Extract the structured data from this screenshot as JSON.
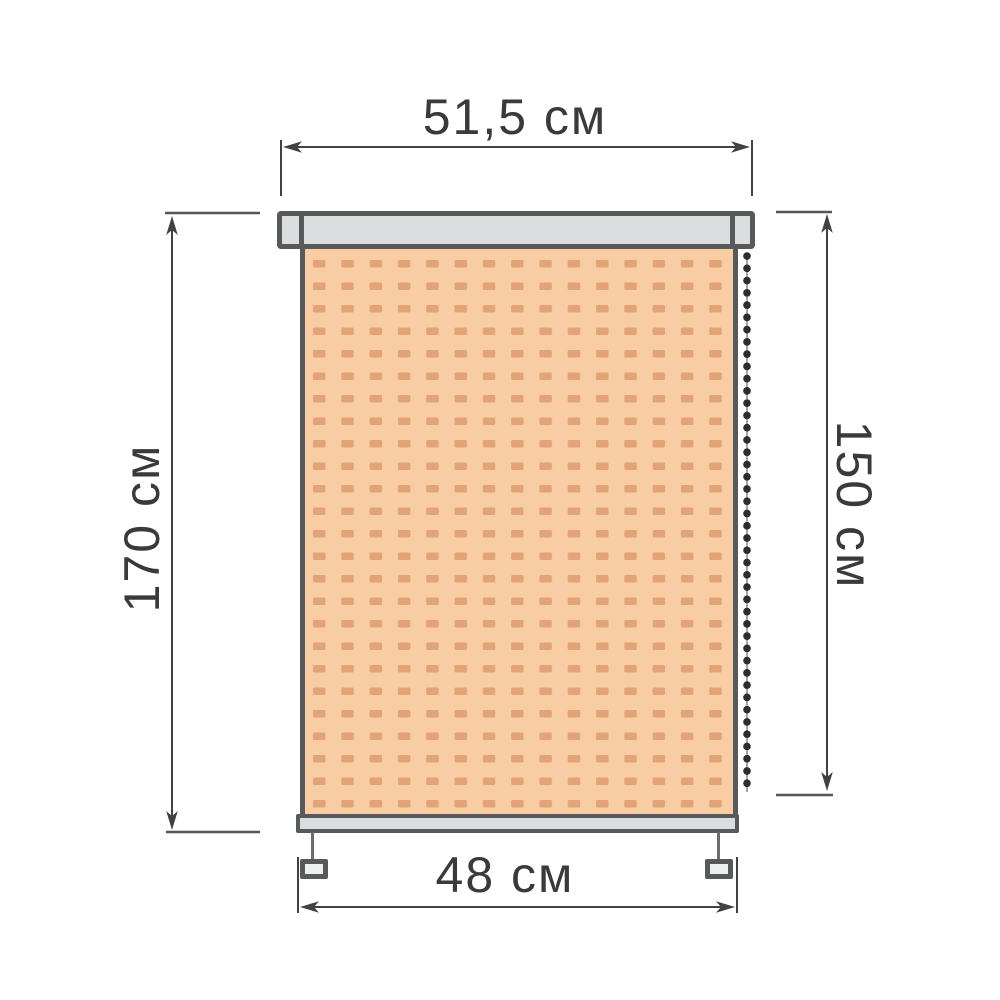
{
  "diagram": {
    "type": "roller-blind-dimension-drawing",
    "labels": {
      "cassette_width": "51,5 см",
      "total_height": "170 см",
      "fabric_height": "150 см",
      "fabric_width": "48 см"
    },
    "colors": {
      "background": "#ffffff",
      "outline": "#58595b",
      "rail_fill": "#dcddde",
      "bottom_bar_fill": "#dbdcdd",
      "bracket_fill": "#eff0f0",
      "fabric_fill": "#f8cda3",
      "fabric_dash": "#e2a377",
      "dimension_line": "#414143",
      "label_text": "#3a3a3c",
      "chain_bead": "#2d2d2f"
    }
  }
}
